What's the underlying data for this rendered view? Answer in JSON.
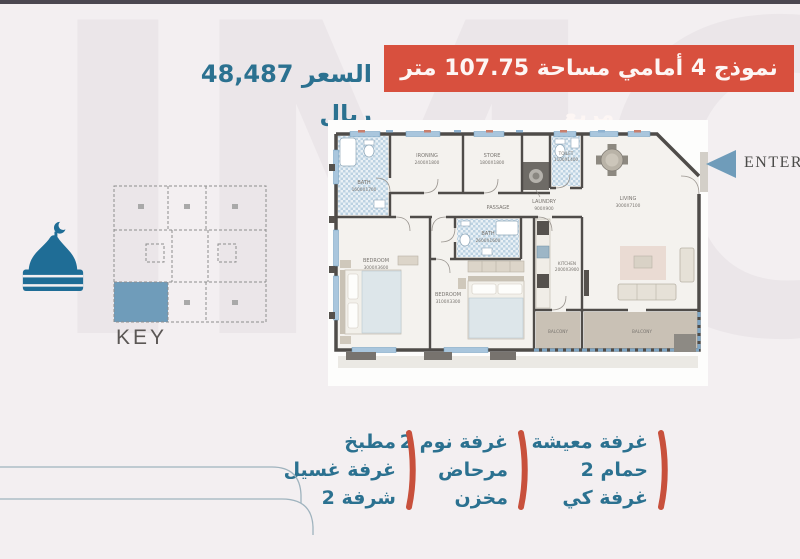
{
  "page": {
    "watermark": "IMC",
    "bg_color": "#f3eff1",
    "topbar_color": "#4b4750"
  },
  "header": {
    "title": "نموذج 4 أمامي مساحة 107.75 متر مربع",
    "title_bg": "#d8503e",
    "price": "السعر 48,487 ريال",
    "price_color": "#2b7190"
  },
  "floorplan": {
    "enter_label": "ENTER",
    "arrow_color": "#6f9cba",
    "rooms": {
      "bath1": {
        "name": "BATH",
        "dims": "1600X1700"
      },
      "ironing": {
        "name": "IRONING",
        "dims": "2400X1800"
      },
      "store": {
        "name": "STORE",
        "dims": "1800X1800"
      },
      "toilet": {
        "name": "TOILET",
        "dims": "1100X1400"
      },
      "laundry": {
        "name": "LAUNDRY",
        "dims": "900X900"
      },
      "passage": {
        "name": "PASSAGE"
      },
      "living": {
        "name": "LIVING",
        "dims": "3000X7100"
      },
      "bath2": {
        "name": "BATH",
        "dims": "2600X1600"
      },
      "bedroom1": {
        "name": "BEDROOM",
        "dims": "3000X3600"
      },
      "bedroom2": {
        "name": "BEDROOM",
        "dims": "3100X3300"
      },
      "kitchen": {
        "name": "KITCHEN",
        "dims": "2000X3900"
      },
      "balcony1": {
        "name": "BALCONY"
      },
      "balcony2": {
        "name": "BALCONY"
      }
    }
  },
  "key": {
    "label": "KEY",
    "unit_color": "#6f9cba"
  },
  "mosque_icon_color": "#1f6d96",
  "features": {
    "accent": "#c8503c",
    "columns": [
      {
        "items": [
          "غرفة معيشة",
          "حمام 2",
          "غرفة كي"
        ]
      },
      {
        "items": [
          "غرفة نوم 2",
          "مرحاض",
          "مخزن"
        ]
      },
      {
        "items": [
          "مطبخ",
          "غرفة غسيل",
          "شرفة 2"
        ]
      }
    ]
  }
}
